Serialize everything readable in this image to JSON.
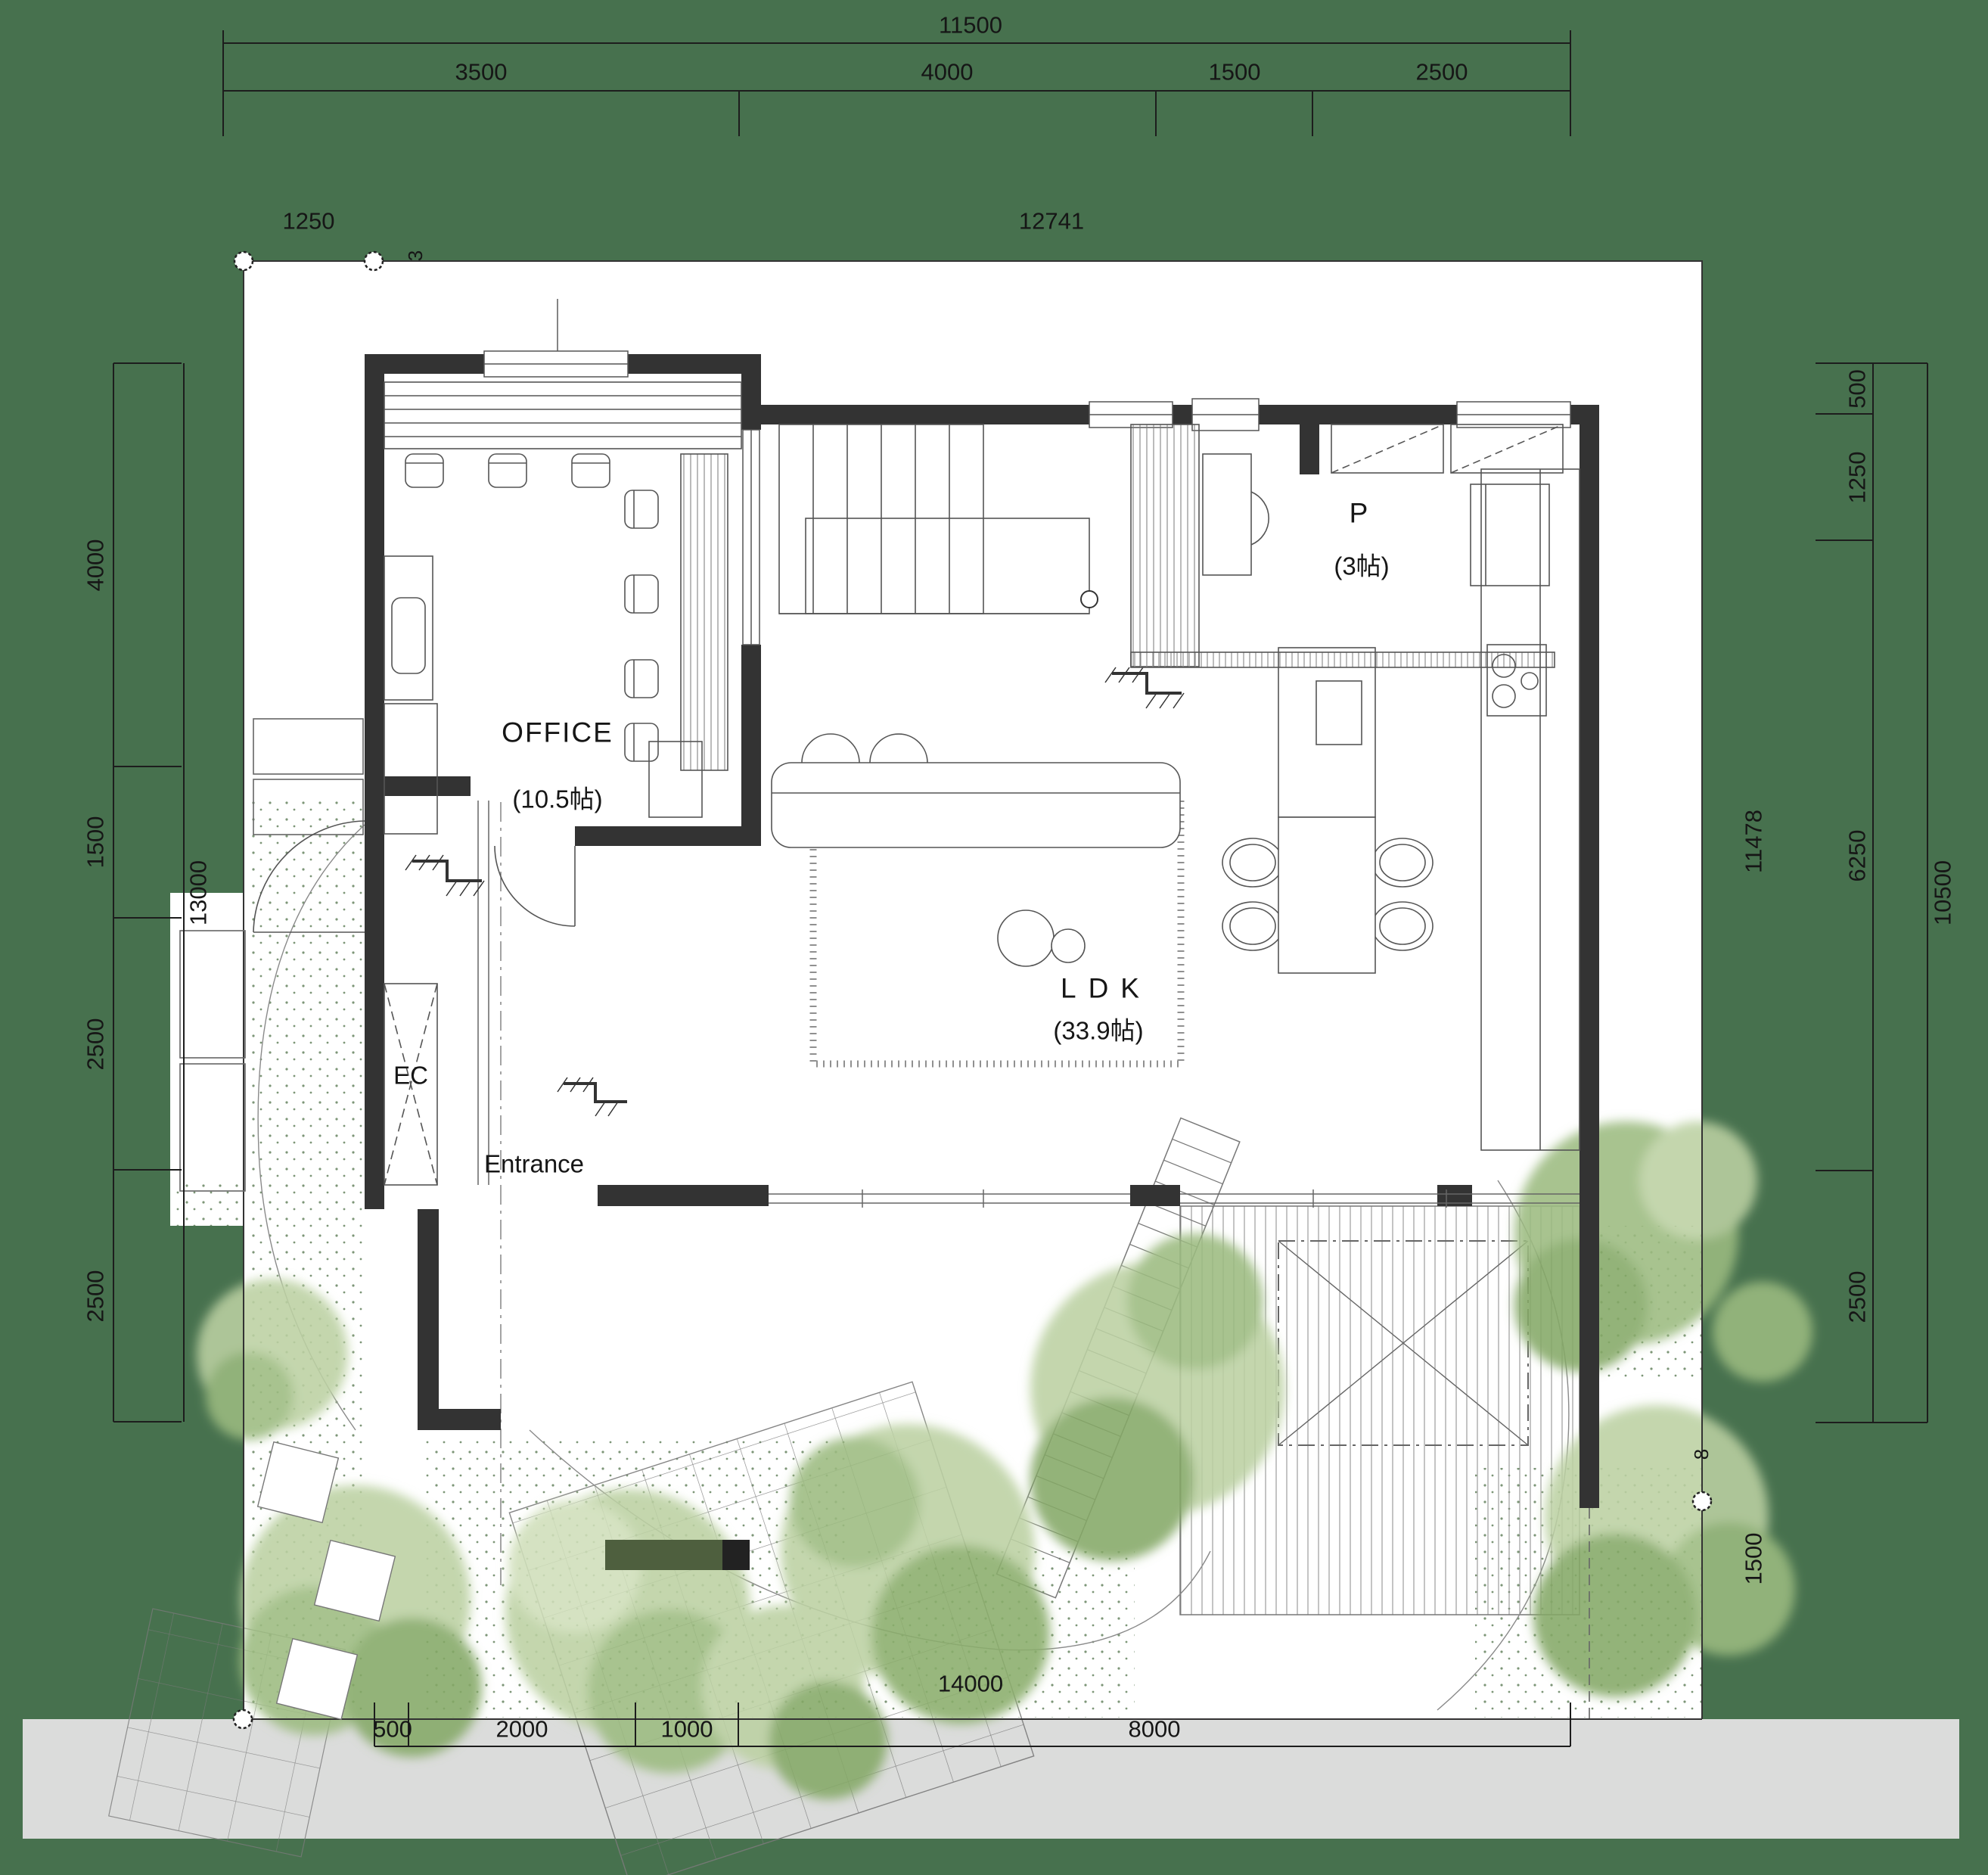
{
  "title": "1F floor plan",
  "colors": {
    "background_green": "#47714e",
    "site_white": "#ffffff",
    "road_gray": "#dbdcdb",
    "wall_black": "#333333",
    "tree_light": "#bcd1a2",
    "tree_mid": "#9dbb80",
    "tree_dark": "#84a967",
    "bench_dark": "#4e5f3e"
  },
  "rooms": {
    "office": {
      "label": "OFFICE",
      "area": "(10.5帖)"
    },
    "pantry": {
      "label": "P",
      "area": "(3帖)"
    },
    "ldk": {
      "label": "LDK",
      "area": "(33.9帖)"
    },
    "entrance_closet": {
      "label": "EC"
    },
    "entrance": {
      "label": "Entrance"
    }
  },
  "dimensions": {
    "top": {
      "total": "11500",
      "segments": [
        "3500",
        "4000",
        "1500",
        "2500"
      ]
    },
    "upper_boundary": {
      "left_offset": "1250",
      "span": "12741",
      "corner_mark": "3"
    },
    "left": {
      "total": "13000",
      "segments": [
        "4000",
        "1500",
        "2500",
        "2500"
      ]
    },
    "right": {
      "total": "10500",
      "segments": [
        "500",
        "1250",
        "6250",
        "2500"
      ],
      "outer_depth": "11478",
      "lower_offset": "1500",
      "corner_mark": "8"
    },
    "bottom": {
      "total": "14000",
      "segments": [
        "500",
        "2000",
        "1000",
        "8000"
      ]
    }
  }
}
